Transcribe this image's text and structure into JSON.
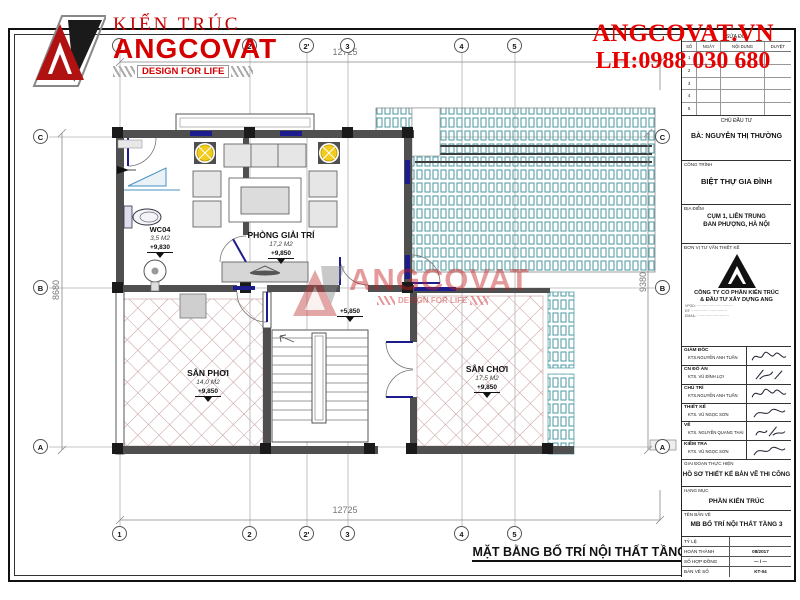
{
  "sheet": {
    "title": "MẶT BẰNG BỐ TRÍ NỘI THẤT TẦNG TUM"
  },
  "brand": {
    "kien_truc": "KIẾN TRÚC",
    "name": "ANGCOVAT",
    "tagline": "DESIGN FOR LIFE",
    "website": "ANGCOVAT.VN",
    "hotline": "LH:0988 030 680"
  },
  "watermark": {
    "name": "ANGCOVAT",
    "tagline": "DESIGN FOR LIFE"
  },
  "grid": {
    "cols": [
      "1",
      "2",
      "2'",
      "3",
      "4",
      "5"
    ],
    "rows": [
      "C",
      "B",
      "A"
    ]
  },
  "dimensions": {
    "top": "12725",
    "bottom": "12725",
    "left": "8680",
    "right": "9380"
  },
  "rooms": {
    "wc": {
      "name": "WC04",
      "area": "3,5 M2",
      "level": "+9,830"
    },
    "entertainment": {
      "name": "PHÒNG GIẢI TRÍ",
      "area": "17,2 M2",
      "level": "+9,850"
    },
    "drying_yard": {
      "name": "SÂN PHƠI",
      "area": "14,0 M2",
      "level": "+9,850"
    },
    "play_yard": {
      "name": "SÂN CHƠI",
      "area": "17,5 M2",
      "level": "+9,850"
    },
    "stair_level": "+5,850"
  },
  "titleblock": {
    "revisions": {
      "title": "SỬA ĐỔI",
      "columns": [
        "SỐ",
        "NGÀY",
        "NỘI DUNG",
        "DUYỆT"
      ],
      "rows": [
        "1",
        "2",
        "3",
        "4",
        "5"
      ]
    },
    "owner": {
      "label": "CHỦ ĐẦU TƯ",
      "value": "BÀ: NGUYỄN THỊ THƯỜNG"
    },
    "project": {
      "label": "CÔNG TRÌNH",
      "value": "BIỆT THỰ GIA ĐÌNH"
    },
    "location": {
      "label": "ĐỊA ĐIỂM",
      "line1": "CỤM 1, LIÊN TRUNG",
      "line2": "ĐAN PHƯỢNG, HÀ NỘI"
    },
    "consultant": {
      "label": "ĐƠN VỊ TƯ VẤN THIẾT KẾ",
      "company_line1": "CÔNG TY CỔ PHẦN KIẾN TRÚC",
      "company_line2": "& ĐẦU TƯ XÂY DỰNG  ANG",
      "addr1": "VPGD: ·······························",
      "addr2": "ĐT: ·············· · ··············",
      "addr3": "EMAIL: ···························"
    },
    "signatures": [
      {
        "label": "GIÁM ĐỐC",
        "name": "KTS.NGUYỄN ANH TUẤN"
      },
      {
        "label": "CN ĐỒ ÁN",
        "name": "KTS. VŨ ĐÌNH LỢI"
      },
      {
        "label": "CHỦ TRÌ",
        "name": "KTS.NGUYỄN ANH TUẤN"
      },
      {
        "label": "THIẾT KẾ",
        "name": "KTS. VŨ NGỌC SƠN"
      },
      {
        "label": "VẼ",
        "name": "KTS. NGUYỄN QUANG THÁI"
      },
      {
        "label": "KIỂM TRA",
        "name": "KTS. VŨ NGỌC SƠN"
      }
    ],
    "stage": {
      "label": "GIAI ĐOẠN THỰC HIỆN",
      "value": "HỒ SƠ THIẾT KẾ BẢN VẼ THI CÔNG"
    },
    "category": {
      "label": "HẠNG MỤC",
      "value": "PHẦN KIẾN TRÚC"
    },
    "drawing": {
      "label": "TÊN BẢN VẼ",
      "value": "MB BỐ TRÍ NỘI THẤT TẦNG 3"
    },
    "info": [
      {
        "label": "TỶ LỆ",
        "value": ""
      },
      {
        "label": "HOÀN THÀNH",
        "value": "08/2017"
      },
      {
        "label": "SỐ HỢP ĐỒNG",
        "value": "—  /  —"
      },
      {
        "label": "BẢN VẼ SỐ",
        "value": "KT-04"
      }
    ]
  },
  "colors": {
    "brand_red": "#d40000",
    "wall": "#4f4f4f",
    "roof_teal": "#4a99a1",
    "hatch_red": "#c49c9c",
    "window_navy": "#1c1c8f",
    "light_yellow": "#f2cb1d"
  }
}
